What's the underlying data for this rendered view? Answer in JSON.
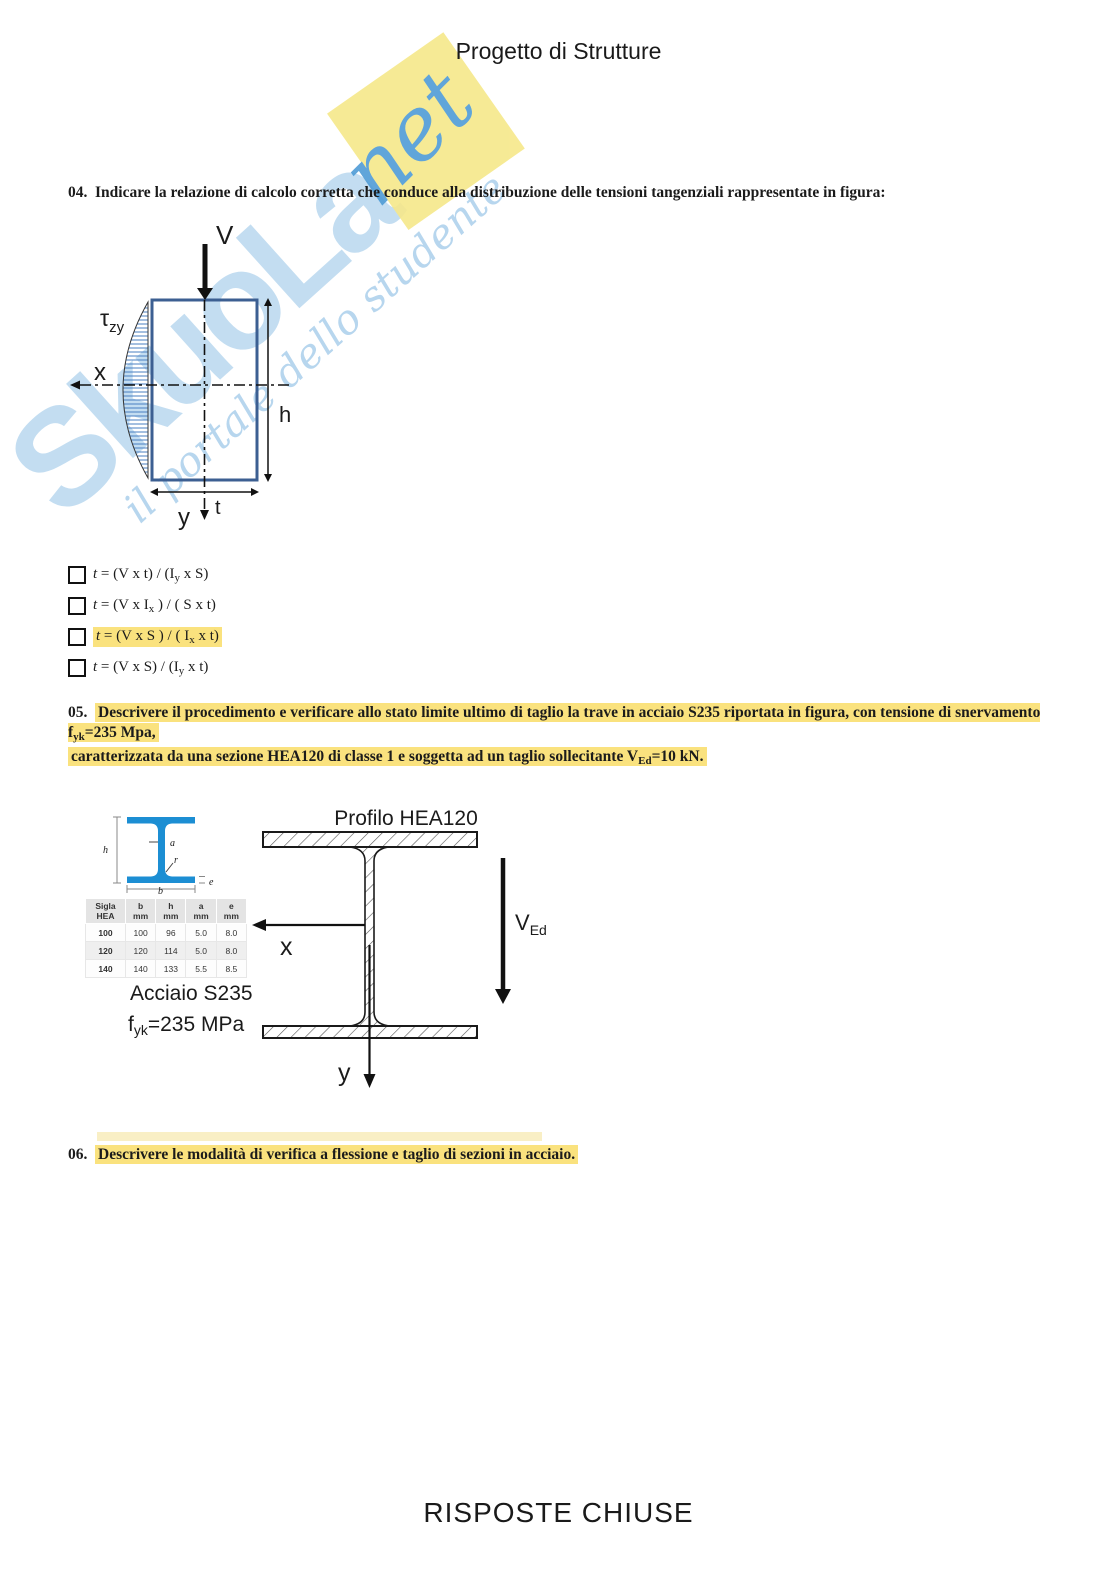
{
  "title": "Progetto di Strutture",
  "footer": "RISPOSTE CHIUSE",
  "colors": {
    "highlight": "#fae27e",
    "section_rect_stroke": "#3c5f92",
    "shear_hatch": "#4a7fc1",
    "hea_profile_blue": "#1c8ed3",
    "watermark_blue": "#b9d8ef",
    "watermark_yellow": "#f6e88a"
  },
  "watermark": {
    "main": "SkuoLa",
    "net": "net",
    "tagline": "il portale dello studente"
  },
  "q04": {
    "number": "04.",
    "text": "Indicare la relazione di calcolo corretta che conduce alla distribuzione delle tensioni tangenziali rappresentate in figura:",
    "fig": {
      "v": "V",
      "tau": "τ",
      "tau_sub": "zy",
      "x": "x",
      "y": "y",
      "h": "h",
      "t": "t"
    },
    "options": [
      {
        "lead": "t",
        "pre": " = (V x t) / (I",
        "sub": "y",
        "post": " x S)",
        "highlighted": false
      },
      {
        "lead": "t",
        "pre": " = (V x I",
        "sub": "x",
        "post": " ) / ( S x t)",
        "highlighted": false
      },
      {
        "lead": "t",
        "pre": " = (V x S ) / ( I",
        "sub": "x",
        "post": " x t)",
        "highlighted": true
      },
      {
        "lead": "t",
        "pre": " = (V x S) / (I",
        "sub": "y",
        "post": " x t)",
        "highlighted": false
      }
    ]
  },
  "q05": {
    "number": "05.",
    "line1_pre": "Descrivere il procedimento e verificare allo stato limite ultimo di taglio la trave in acciaio S235 riportata in figura, con tensione di snervamento f",
    "line1_sub": "yk",
    "line1_post": "=235 Mpa,",
    "line2_pre": "caratterizzata da una sezione HEA120 di classe 1 e soggetta ad un taglio sollecitante V",
    "line2_sub": "Ed",
    "line2_post": "=10 kN.",
    "fig": {
      "title": "Profilo HEA120",
      "x": "x",
      "y": "y",
      "ved_main": "V",
      "ved_sub": "Ed",
      "steel": "Acciaio S235",
      "fyk_pre": "f",
      "fyk_sub": "yk",
      "fyk_post": "=235 MPa",
      "small": {
        "h": "h",
        "a": "a",
        "r": "r",
        "b": "b",
        "e": "e"
      },
      "table": {
        "headers": [
          {
            "l1": "Sigla",
            "l2": "HEA"
          },
          {
            "l1": "b",
            "l2": "mm"
          },
          {
            "l1": "h",
            "l2": "mm"
          },
          {
            "l1": "a",
            "l2": "mm"
          },
          {
            "l1": "e",
            "l2": "mm"
          }
        ],
        "rows": [
          [
            "100",
            "100",
            "96",
            "5.0",
            "8.0"
          ],
          [
            "120",
            "120",
            "114",
            "5.0",
            "8.0"
          ],
          [
            "140",
            "140",
            "133",
            "5.5",
            "8.5"
          ]
        ]
      }
    }
  },
  "q06": {
    "number": "06.",
    "text": "Descrivere le modalità di verifica a flessione e taglio di sezioni in acciaio."
  }
}
